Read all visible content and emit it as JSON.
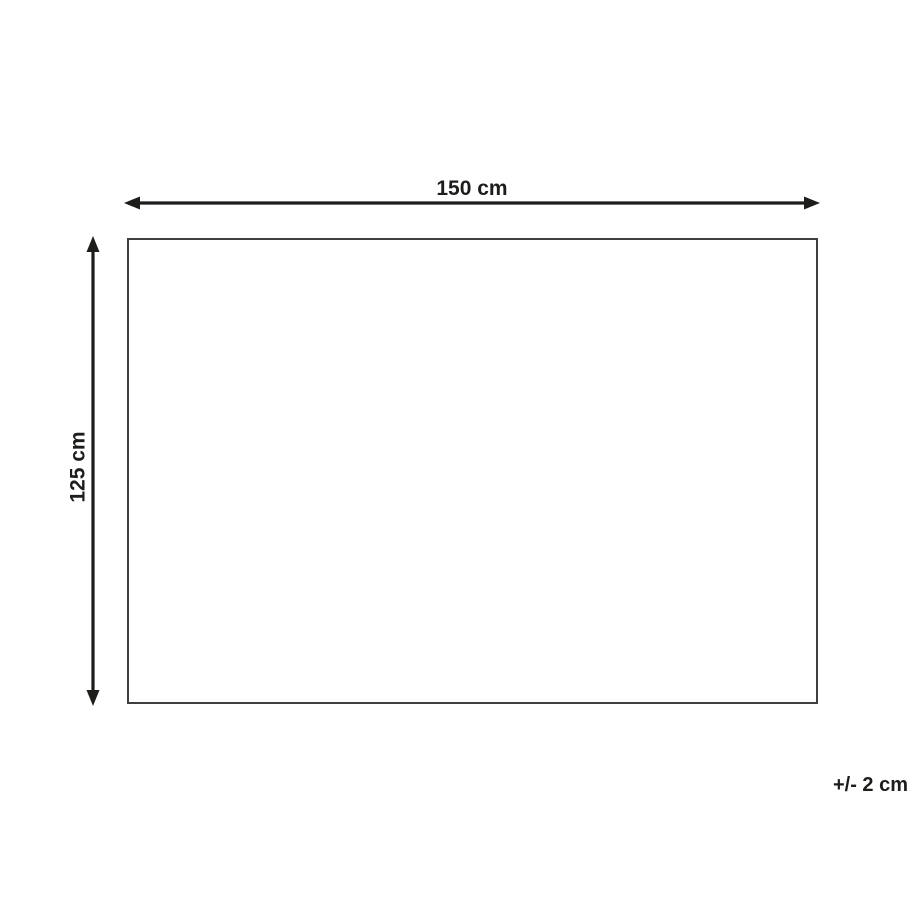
{
  "diagram": {
    "width_label": "150 cm",
    "height_label": "125 cm",
    "tolerance_label": "+/- 2 cm"
  },
  "icons": {
    "width_arrow": "double-headed-horizontal-arrow",
    "height_arrow": "double-headed-vertical-arrow"
  },
  "colors": {
    "line": "#1d1d1b",
    "rect-border": "#3f3f3f",
    "text": "#1d1d1b",
    "background": "#ffffff"
  }
}
